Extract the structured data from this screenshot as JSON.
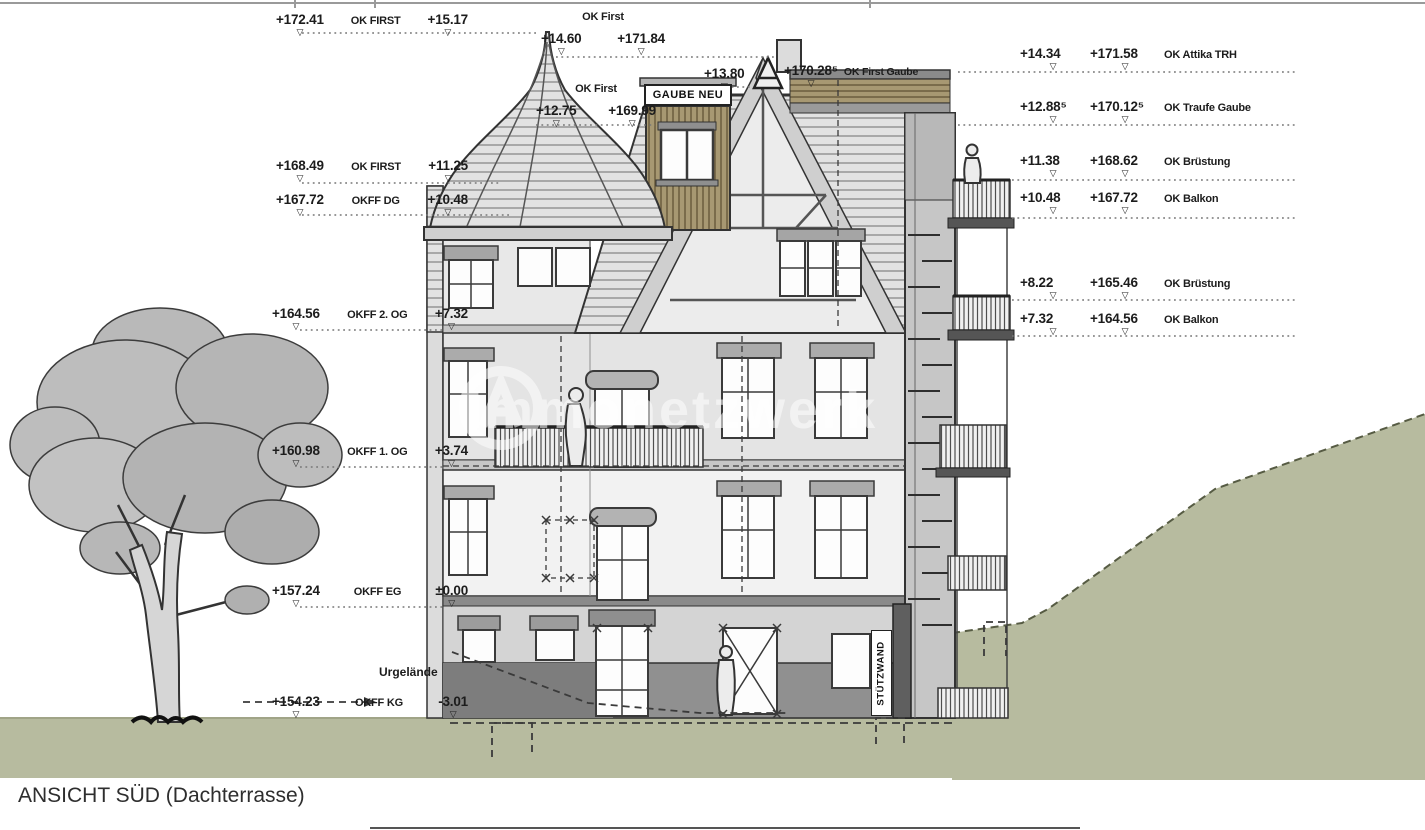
{
  "title": "ANSICHT SÜD (Dachterrasse)",
  "watermark": "Immonetzwerk",
  "labels": {
    "gaube_neu": "GAUBE NEU",
    "stuetzwand": "STÜTZWAND",
    "urgelaende": "Urgelände"
  },
  "annotations": {
    "left": [
      {
        "abs": "+172.41",
        "label": "OK FIRST",
        "rel": "+15.17"
      },
      {
        "abs": "+168.49",
        "label": "OK FIRST",
        "rel": "+11.25"
      },
      {
        "abs": "+167.72",
        "label": "OKFF DG",
        "rel": "+10.48"
      },
      {
        "abs": "+164.56",
        "label": "OKFF 2. OG",
        "rel": "+7.32"
      },
      {
        "abs": "+160.98",
        "label": "OKFF 1. OG",
        "rel": "+3.74"
      },
      {
        "abs": "+157.24",
        "label": "OKFF EG",
        "rel": "±0.00"
      },
      {
        "abs": "+154.23",
        "label": "OKFF KG",
        "rel": "-3.01"
      }
    ],
    "top": [
      {
        "label": "OK First",
        "rel": "+14.60",
        "abs": "+171.84"
      },
      {
        "label": "OK First",
        "rel": "+12.75",
        "abs": "+169.99"
      },
      {
        "rel": "+13.80",
        "abs": "+170.28⁵",
        "label": "OK First Gaube"
      }
    ],
    "right": [
      {
        "rel": "+14.34",
        "abs": "+171.58",
        "label": "OK Attika TRH"
      },
      {
        "rel": "+12.88⁵",
        "abs": "+170.12⁵",
        "label": "OK Traufe Gaube"
      },
      {
        "rel": "+11.38",
        "abs": "+168.62",
        "label": "OK Brüstung"
      },
      {
        "rel": "+10.48",
        "abs": "+167.72",
        "label": "OK Balkon"
      },
      {
        "rel": "+8.22",
        "abs": "+165.46",
        "label": "OK Brüstung"
      },
      {
        "rel": "+7.32",
        "abs": "+164.56",
        "label": "OK Balkon"
      }
    ]
  },
  "colors": {
    "ground_green": "#b7bb9f",
    "wood": "#a79872",
    "facade": "#ececec",
    "line_dark": "#333333"
  }
}
